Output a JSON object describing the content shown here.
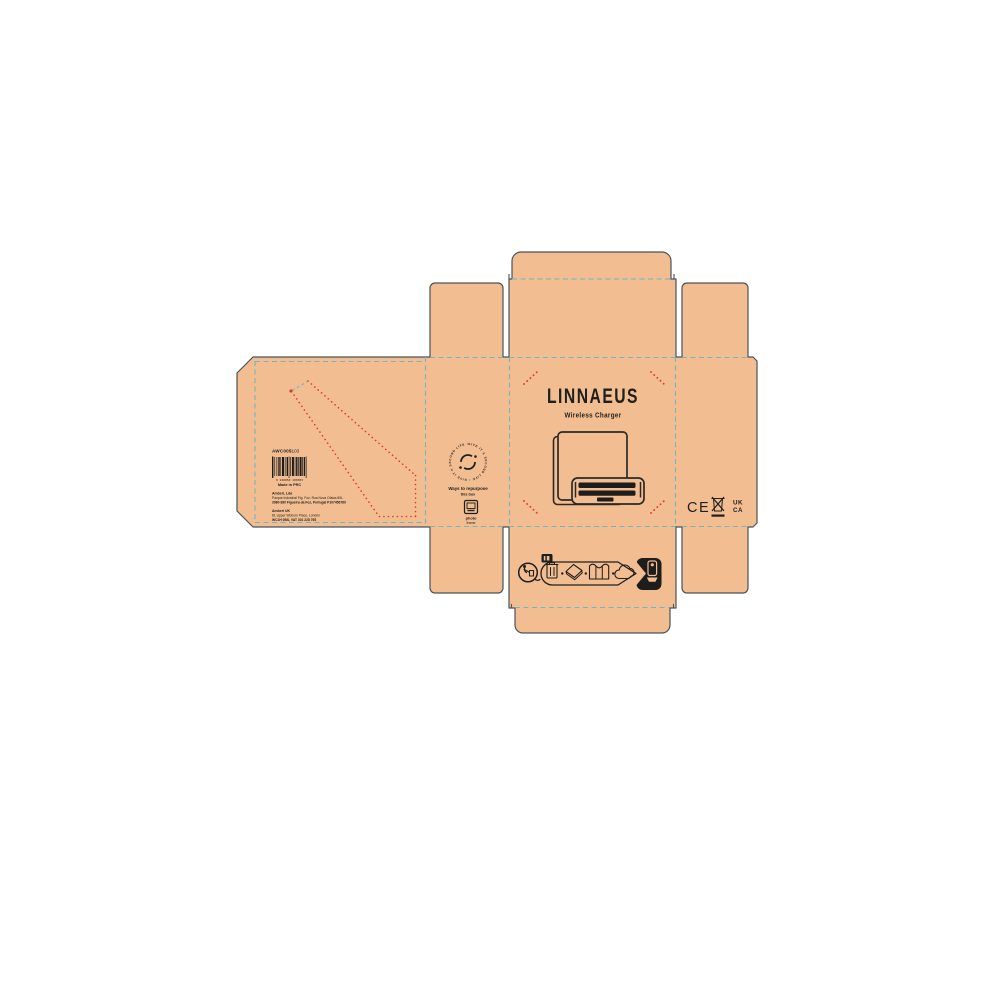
{
  "brand": {
    "name": "LINNAEUS",
    "product": "Wireless Charger"
  },
  "left_panel": {
    "sku": "AWC005",
    "sku_suffix": "-103",
    "barcode_digits": "0 220050 100303",
    "made_in": "Made in PRC",
    "address_pt_name": "Amberi, Lda",
    "address_pt_line1": "Parque Industrial Fig. Foz, Rua Nova Olaias 89L",
    "address_pt_line2": "3080-380 Figueira da Foz, Portugal P107456789",
    "address_uk_name": "Amberi UK",
    "address_uk_line1": "81 Upper Woburn Place, London",
    "address_uk_line2": "WC1H 0BS, VAT 301 228 765"
  },
  "repurpose_flap": {
    "stamp_ring_text": "GIVE IT A SECOND LIFE • GIVE IT A SECOND LIFE •",
    "heading": "Ways to repurpose",
    "subheading": "this box",
    "suggestion_top": "photo",
    "suggestion_bottom": "frame"
  },
  "compliance": {
    "ce_mark": "CE",
    "ukca_top": "UK",
    "ukca_bottom": "CA"
  },
  "colors": {
    "kraft": "#f2bd90",
    "cut_outline": "#4b5359",
    "fold_teal": "#74b5c3",
    "perforation_red": "#e2392c",
    "print_black": "#1d1d1b"
  }
}
